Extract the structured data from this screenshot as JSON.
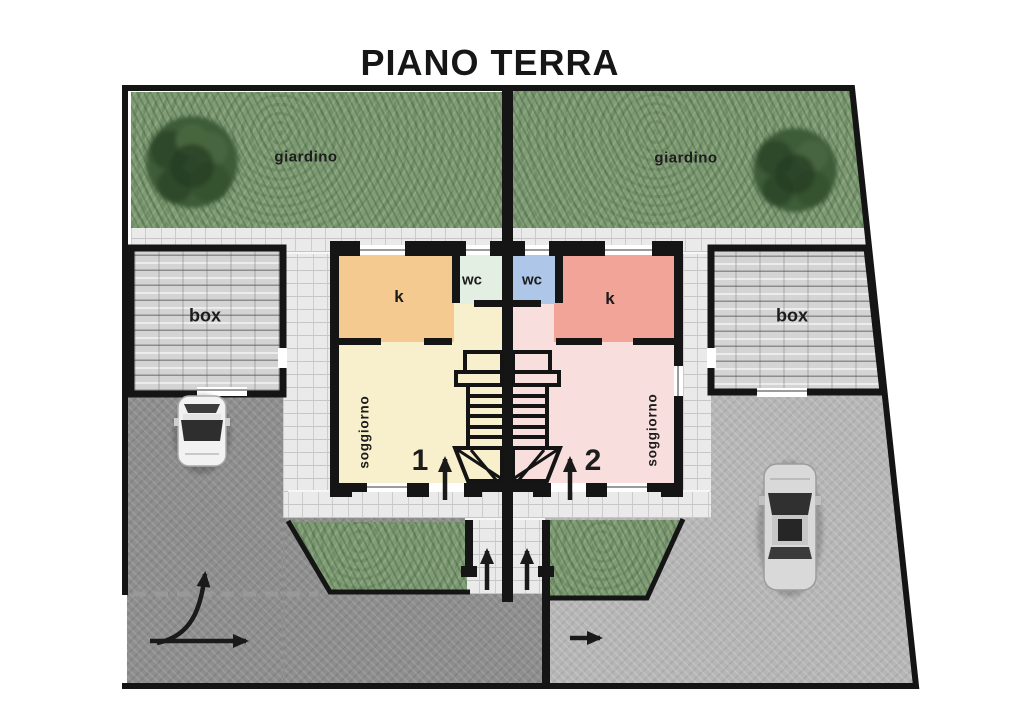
{
  "title": "PIANO TERRA",
  "site": {
    "garden_left_label": "giardino",
    "garden_right_label": "giardino",
    "garage_left_label": "box",
    "garage_right_label": "box"
  },
  "units": [
    {
      "number": "1",
      "kitchen_label": "k",
      "wc_label": "wc",
      "living_label": "soggiorno"
    },
    {
      "number": "2",
      "kitchen_label": "k",
      "wc_label": "wc",
      "living_label": "soggiorno"
    }
  ],
  "colors": {
    "wall": "#151515",
    "grass": "#7f9c74",
    "pavers": "#eaeaea",
    "garage_roof": "#d4d4d4",
    "asphalt_dark": "#8e8e8e",
    "asphalt_light": "#b6b6b6",
    "kitchen_unit1": "#f5ca90",
    "living_unit1": "#f8f0cd",
    "wc_unit1": "#e2efe2",
    "kitchen_unit2": "#f2a498",
    "living_unit2": "#f9dede",
    "wc_unit2": "#aec7e9"
  }
}
